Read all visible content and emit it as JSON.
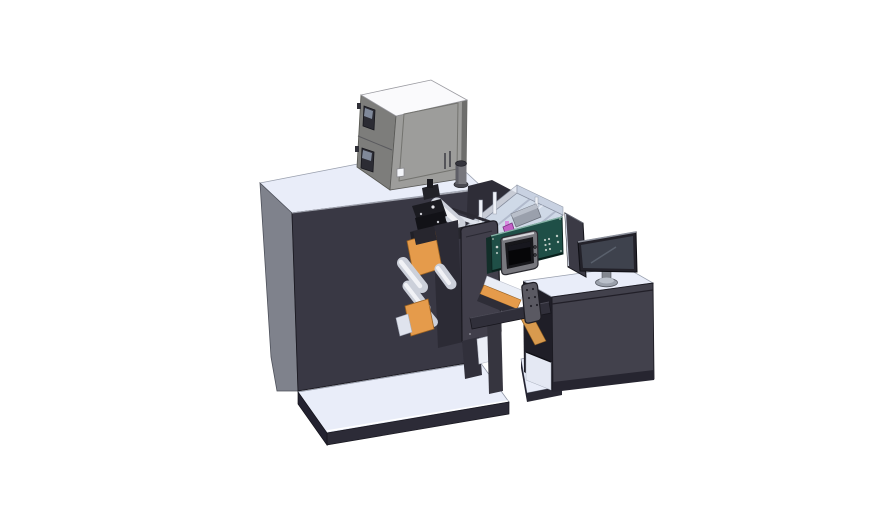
{
  "scene": {
    "description": "Isometric 3D CAD render of an industrial label printing and converting machine: large dark cabinet with electrical box on top, web rollers and orange guide plates, transparent inspection enclosure with magenta part, dark-green control housing with touchscreen, outfeed slide, and an operator desk with a monitor on the right.",
    "text_visible_in_image": ""
  },
  "colors": {
    "bg": "#ffffff",
    "light": "#e9edf9",
    "machine_left": "#7f828c",
    "machine_dark": "#393844",
    "edge_dark": "#23222c",
    "platform_edge": "#2c2b37",
    "cab_top": "#fafafc",
    "cab_front": "#9d9d9b",
    "cab_left": "#7d7d7b",
    "orange": "#e59b4b",
    "green": "#1f4f47",
    "glass": "#ccd6e6",
    "magenta": "#c45fc7",
    "roller": "#ccd0da",
    "roller_hi": "#f1f2f6",
    "desk_front": "#42414c",
    "monitor_screen": "#3e424d",
    "bezel_dark": "#23222a",
    "metal": "#77777d",
    "stand": "#9aa0ab",
    "panel": "#413f4b",
    "beam": "#302f3a",
    "interior": "#1f1e27"
  },
  "components": [
    {
      "id": "main-machine-cabinet",
      "label": "Main machine body"
    },
    {
      "id": "electrical-cabinet",
      "label": "Electrical cabinet on top"
    },
    {
      "id": "base-platform",
      "label": "Machine base platform"
    },
    {
      "id": "print-mechanism",
      "label": "Print head mechanism"
    },
    {
      "id": "web-rollers",
      "label": "Web guide rollers"
    },
    {
      "id": "orange-guide-plates",
      "label": "Orange guide plates"
    },
    {
      "id": "front-cover-panel",
      "label": "Front cover panel"
    },
    {
      "id": "glass-enclosure",
      "label": "Transparent inspection enclosure"
    },
    {
      "id": "control-housing",
      "label": "Green control housing"
    },
    {
      "id": "touchscreen",
      "label": "Operator touchscreen"
    },
    {
      "id": "outfeed-slide",
      "label": "Outfeed slide with orange strip"
    },
    {
      "id": "connecting-beam",
      "label": "Connecting beam"
    },
    {
      "id": "operator-desk",
      "label": "Operator desk"
    },
    {
      "id": "desk-monitor",
      "label": "Desk monitor"
    },
    {
      "id": "side-glass-panel",
      "label": "Side safety panel"
    },
    {
      "id": "handle-panel",
      "label": "Handle panel with dots"
    }
  ]
}
